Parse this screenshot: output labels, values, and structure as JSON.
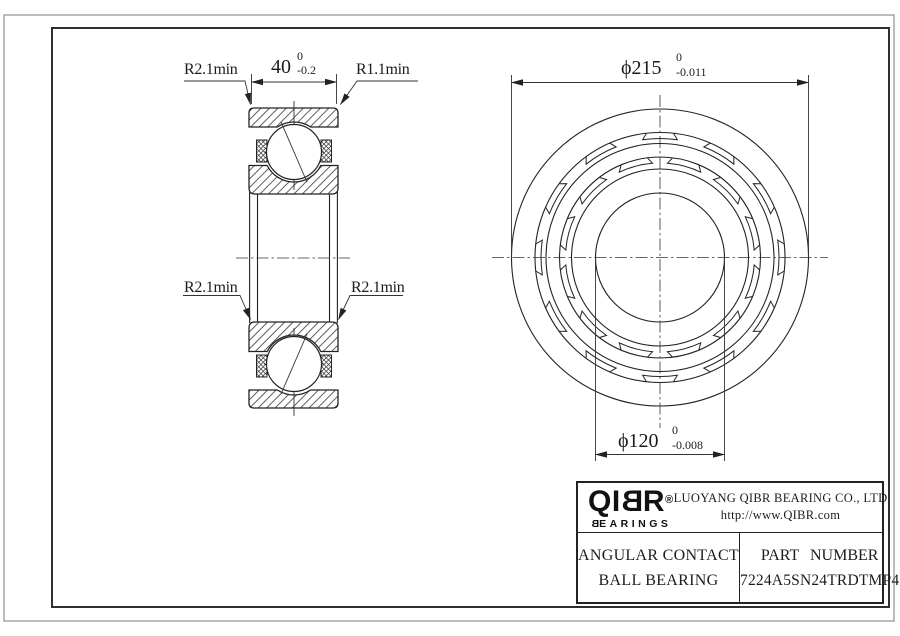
{
  "colors": {
    "line": "#222222",
    "background": "#ffffff"
  },
  "views": {
    "section": {
      "width_dim": {
        "value": "40",
        "tol_upper": "0",
        "tol_lower": "-0.2"
      },
      "fillet_top_left": "R2.1min",
      "fillet_top_right": "R1.1min",
      "fillet_mid_left": "R2.1min",
      "fillet_mid_right": "R2.1min"
    },
    "front": {
      "outer_dia": {
        "value": "ϕ215",
        "tol_upper": "0",
        "tol_lower": "-0.011"
      },
      "bore_dia": {
        "value": "ϕ120",
        "tol_upper": "0",
        "tol_lower": "-0.008"
      }
    }
  },
  "title_block": {
    "logo": {
      "pre": "QI",
      "mirrored": "B",
      "post": "R",
      "registered": "®",
      "sub_mirrored": "B",
      "sub_post": "EARINGS"
    },
    "company": "LUOYANG QIBR BEARING CO., LTD",
    "website": "http://www.QIBR.com",
    "product_line1": "ANGULAR CONTACT",
    "product_line2": "BALL BEARING",
    "part_label": "PART NUMBER",
    "part_number": "7224A5SN24TRDTMP4"
  }
}
